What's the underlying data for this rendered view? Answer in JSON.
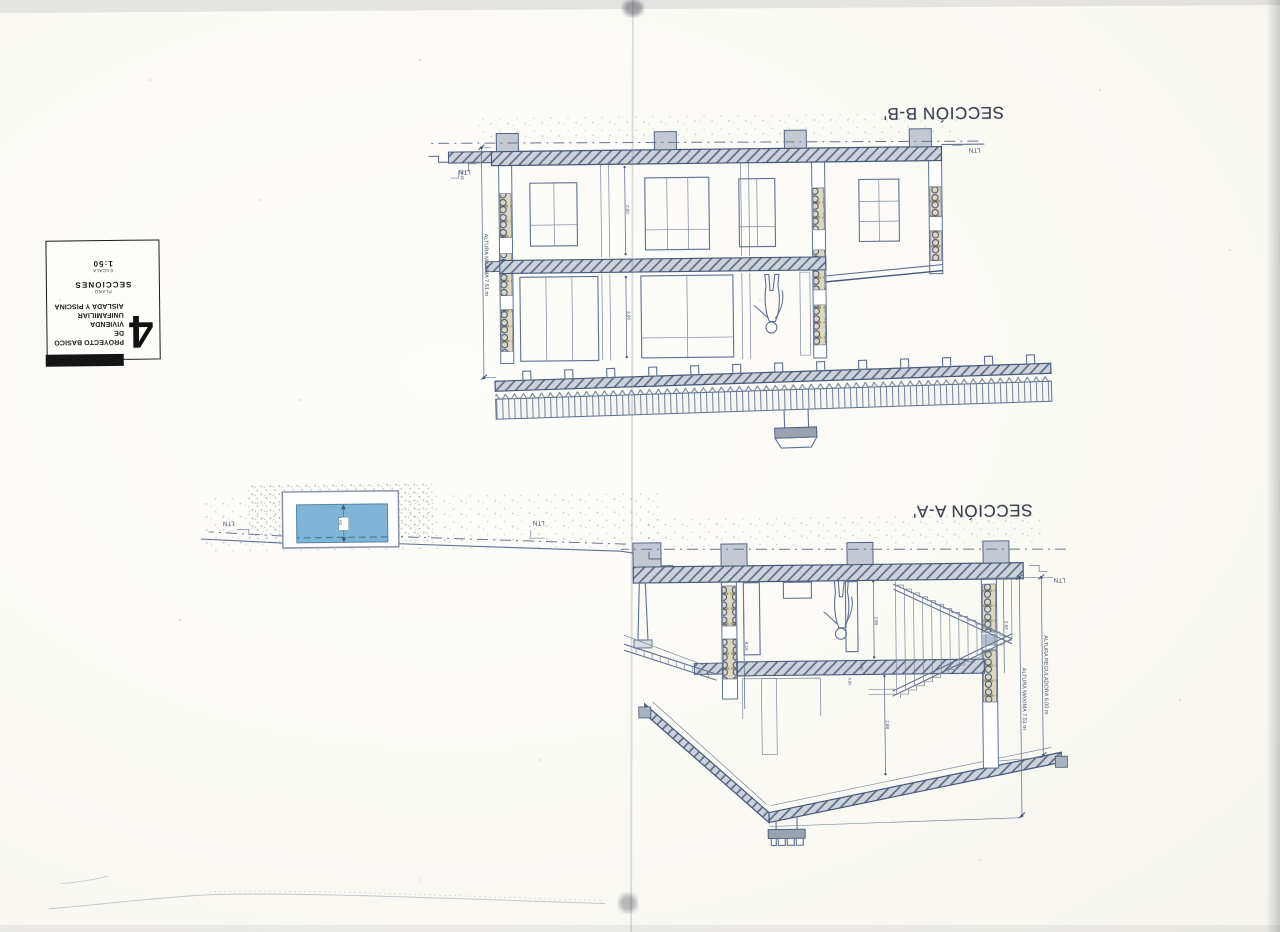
{
  "titles": {
    "section_bb": "SECCIÓN B-B'",
    "section_aa": "SECCIÓN A-A'"
  },
  "labels": {
    "ltn": "LTN",
    "altura_maxima": "ALTURA MAXIMA 7.51 m",
    "altura_reguladora": "ALTURA REGULADORA 6.00 m"
  },
  "dims": {
    "bb_upper": "3.06",
    "bb_lower": "2.60",
    "bb_step": "0.45",
    "aa_room1": "2.80",
    "aa_room2": "2.88",
    "aa_left": "2.52",
    "aa_tall": "6.16",
    "aa_s1": "0.30",
    "aa_s2": "0.90",
    "pool_depth": "1.50"
  },
  "title_block": {
    "number": "4",
    "project_line1": "PROYECTO BASICO DE",
    "project_line2": "VIVIENDA UNIFAMILIAR",
    "project_line3": "AISLADA Y PISCINA",
    "plano_label": "PLANO",
    "plano_value": "SECCIONES",
    "escala_label": "ESCALA",
    "escala_value": "1:50"
  },
  "colors": {
    "pool_water": "#7fb5d7",
    "ink": "#5f7191",
    "paper": "#fbfaf6"
  }
}
